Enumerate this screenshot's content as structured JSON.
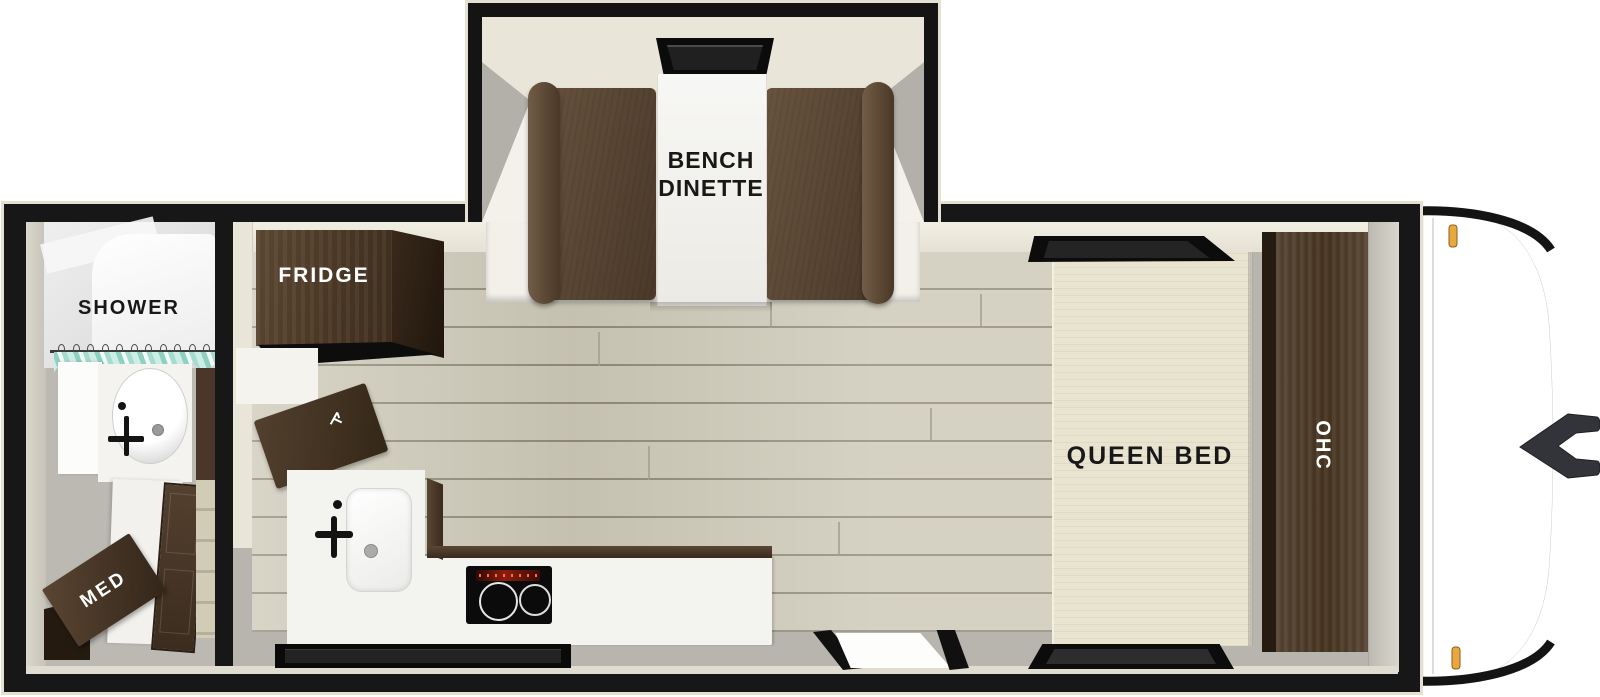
{
  "scene": {
    "description": "Top-down 3D floor plan of a travel trailer RV",
    "labels": {
      "shower": "SHOWER",
      "med": "MED",
      "fridge": "FRIDGE",
      "bench_dinette": "BENCH\nDINETTE",
      "queen_bed": "QUEEN BED",
      "ohc": "OHC"
    },
    "colors": {
      "background": "#ffffff",
      "wall_black": "#171717",
      "outline_cream": "#e4e1d4",
      "interior_wall": "#eae7db",
      "wood_floor": "#cdc9b8",
      "floor_gray": "#b8b5ae",
      "cabinet_brown": "#4e3b2c",
      "bench_brown": "#5d4836",
      "bed_cream": "#e9e4d0",
      "counter_white": "#f3f3f0",
      "curtain_teal": "#8fd0c0",
      "marker_light_amber": "#e9a83f"
    }
  }
}
